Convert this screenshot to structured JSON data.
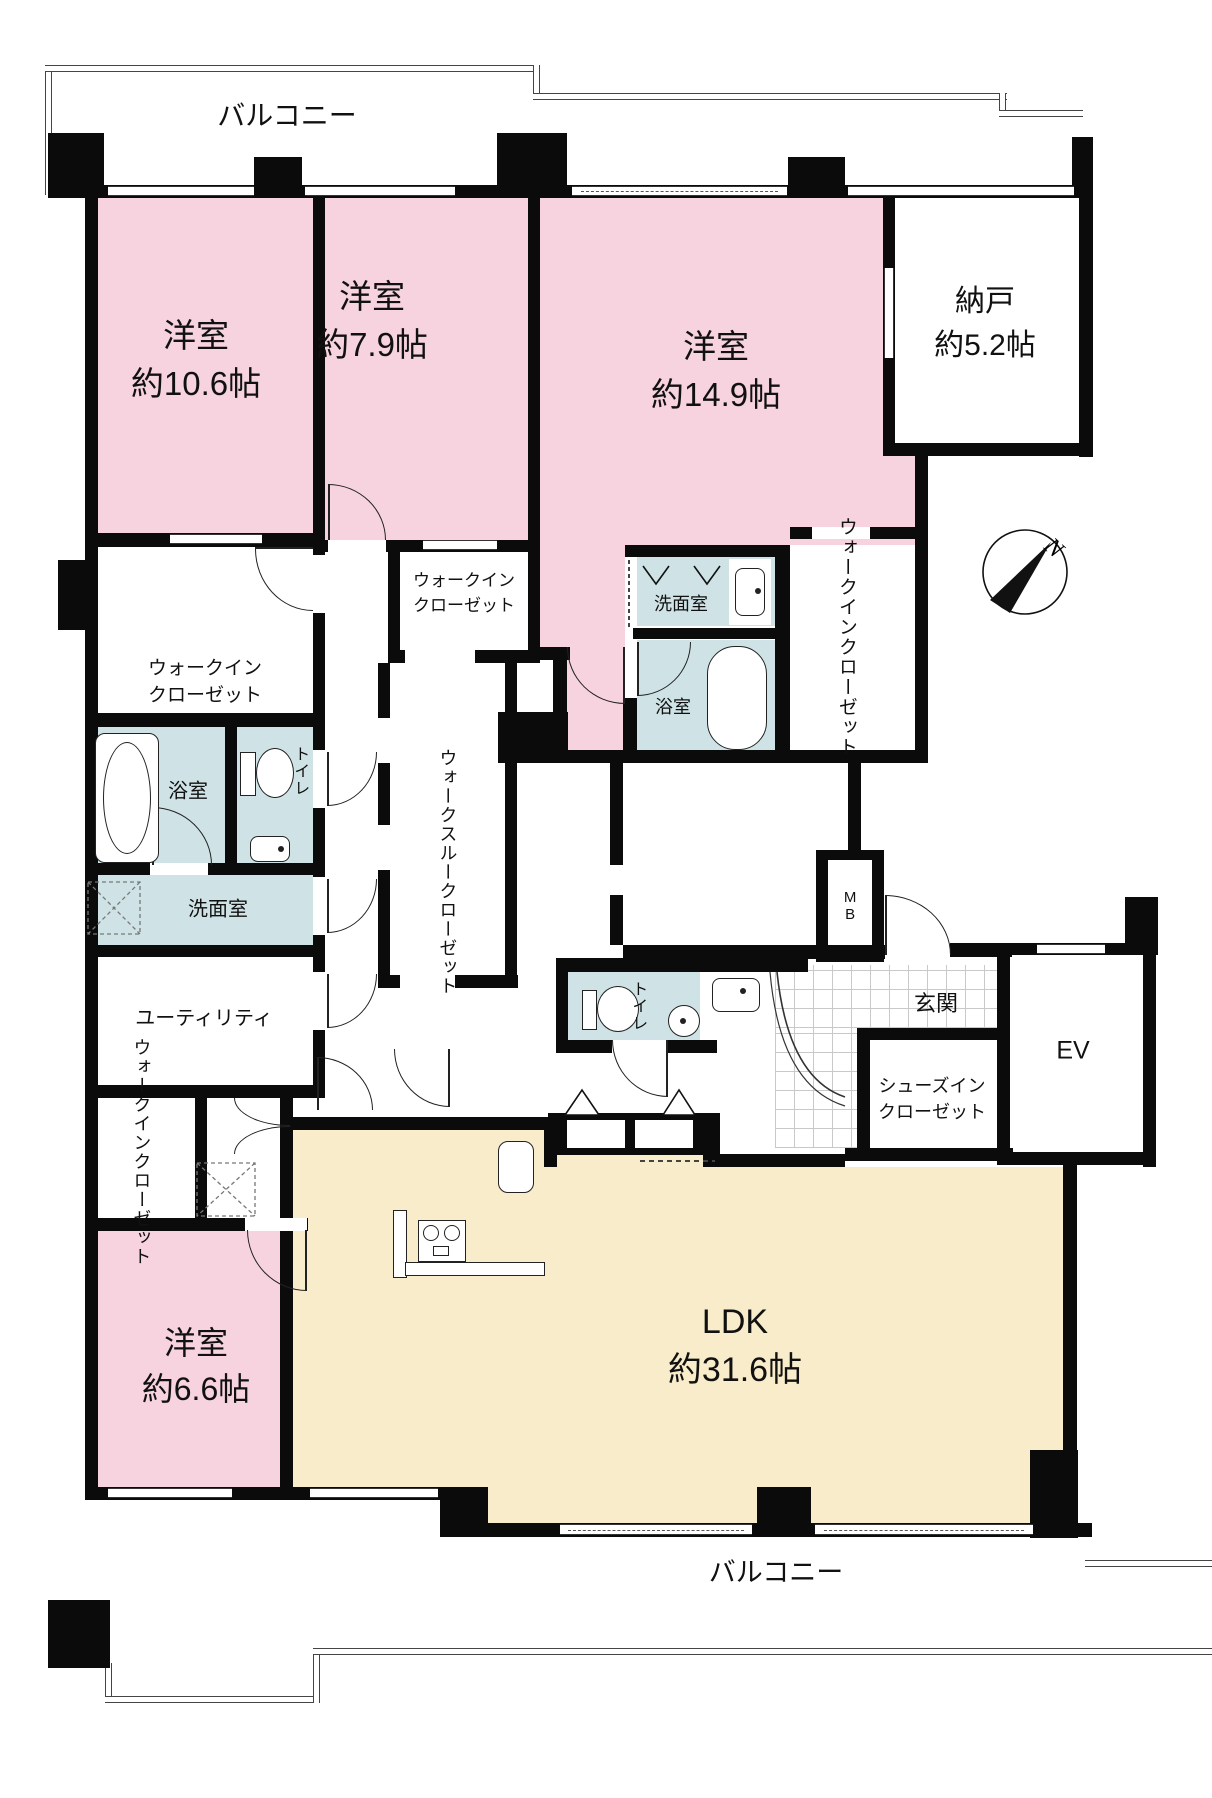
{
  "plan_title": "4LDK floor plan",
  "colors": {
    "room_pink": "#f6d3df",
    "ldk_cream": "#f8ecca",
    "wet_blue": "#cfe3e6",
    "wall": "#0b0b0b"
  },
  "compass": {
    "label": "N"
  },
  "labels": {
    "balcony_top": "バルコニー",
    "balcony_bottom": "バルコニー",
    "room_10_6": {
      "name": "洋室",
      "size": "約10.6帖"
    },
    "room_7_9": {
      "name": "洋室",
      "size": "約7.9帖"
    },
    "room_14_9": {
      "name": "洋室",
      "size": "約14.9帖"
    },
    "storage_5_2": {
      "name": "納戸",
      "size": "約5.2帖"
    },
    "room_6_6": {
      "name": "洋室",
      "size": "約6.6帖"
    },
    "ldk": {
      "name": "LDK",
      "size": "約31.6帖"
    },
    "wic_left": {
      "line1": "ウォークイン",
      "line2": "クローゼット"
    },
    "wic_top": {
      "line1": "ウォークイン",
      "line2": "クローゼット"
    },
    "wic_right": {
      "line1": "ウォークイン",
      "line2": "クローゼット"
    },
    "wic_bottom": {
      "line1": "ウォークイン",
      "line2": "クローゼット"
    },
    "walk_through_closet": {
      "line1": "ウォークスルー",
      "line2": "クローゼット"
    },
    "shoes_in_closet": {
      "line1": "シューズイン",
      "line2": "クローゼット"
    },
    "washroom_left": "洗面室",
    "washroom_right": "洗面室",
    "bath_left": "浴室",
    "bath_right": "浴室",
    "toilet_left": "トイレ",
    "toilet_center": "トイレ",
    "utility": "ユーティリティ",
    "entrance": "玄関",
    "elevator": "EV",
    "meter_box": "MB"
  }
}
